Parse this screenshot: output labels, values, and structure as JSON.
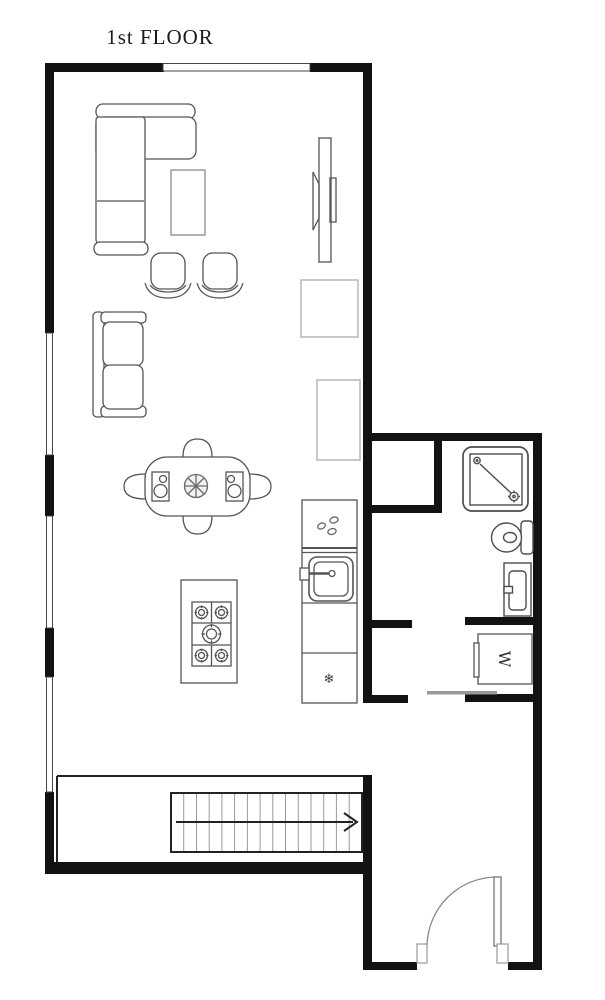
{
  "title": "1st FLOOR",
  "labels": {
    "washer": "W"
  },
  "icons": {
    "freezer_snowflake": "❄"
  },
  "colors": {
    "wall": "#121212",
    "furniture_outline": "#555555",
    "light_outline": "#b7b7b7",
    "stair_tread": "#9a9a9a",
    "door_swing": "#8a8a8a",
    "background": "#ffffff"
  }
}
